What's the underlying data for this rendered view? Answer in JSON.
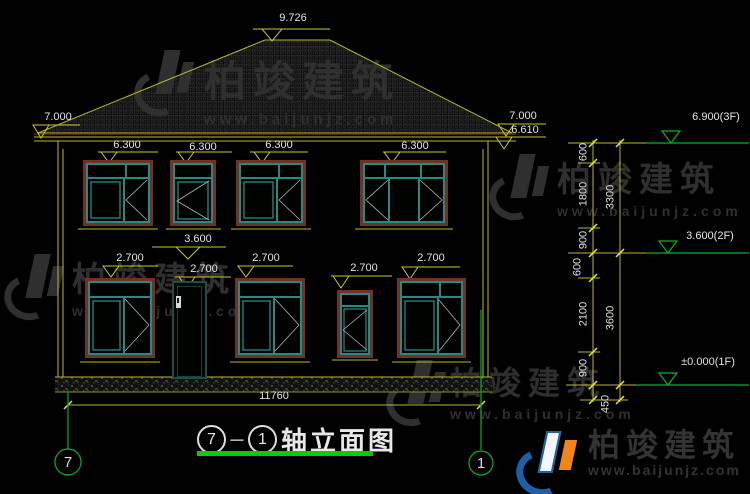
{
  "title": {
    "axis_start": "7",
    "dash": "－",
    "axis_end": "1",
    "label": "轴立面图"
  },
  "axis_bubbles": {
    "left": "7",
    "right": "1"
  },
  "dimensions": {
    "ridge": "9.726",
    "eave_left": "7.000",
    "eave_right_top": "7.000",
    "eave_right_bottom": "6.610",
    "roof_6300": [
      "6.300",
      "6.300",
      "6.300",
      "6.300"
    ],
    "mid_3600": "3.600",
    "head_2700": [
      "2.700",
      "2.700",
      "2.700",
      "2.700",
      "2.700"
    ],
    "total_width": "11760",
    "right_levels": [
      "6.900(3F)",
      "3.600(2F)",
      "±0.000(1F)"
    ],
    "right_chain_inner": [
      "600",
      "1800",
      "900",
      "600",
      "2100",
      "900",
      "450"
    ],
    "right_chain_outer": [
      "3300",
      "3600"
    ]
  },
  "watermark": {
    "brand": "柏竣建筑",
    "url": "www.baijunjz.com"
  },
  "logo": {
    "brand": "柏竣建筑",
    "url": "www.baijunjz.com"
  },
  "colors": {
    "background": "#000000",
    "cad_yellow": "#b9b92c",
    "cad_green": "#00b22d",
    "window_teal": "#2e8585",
    "frame_brown": "#6e3324",
    "title_underline": "#00cf00",
    "logo_blue": "#1e5fa8",
    "logo_orange": "#f08519"
  }
}
